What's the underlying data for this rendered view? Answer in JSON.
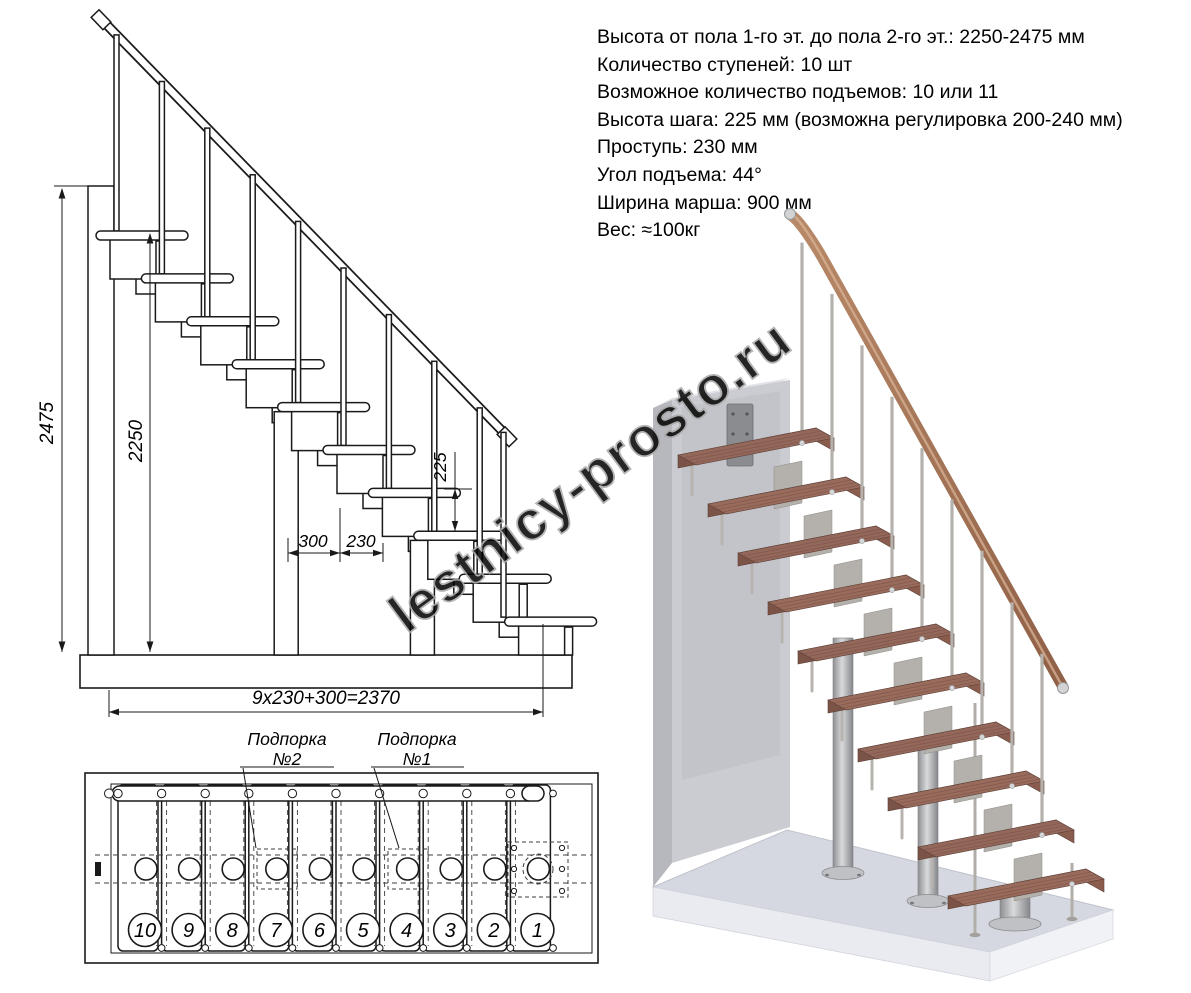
{
  "page": {
    "watermark_text": "lestnicy-prosto.ru"
  },
  "specs": {
    "lines": [
      "Высота от пола 1-го эт. до пола 2-го эт.: 2250-2475 мм",
      "Количество ступеней: 10 шт",
      "Возможное количество подъемов: 10 или 11",
      "Высота шага: 225 мм (возможна регулировка 200-240 мм)",
      "Проступь: 230 мм",
      "Угол подъема: 44°",
      "Ширина марша: 900 мм",
      "Вес: ≈100кг"
    ]
  },
  "side_view": {
    "dim_total_height": "2475",
    "dim_clear_height": "2250",
    "dim_step_rise": "225",
    "dim_top_run": "300",
    "dim_tread_run": "230",
    "dim_total_run": "9x230+300=2370"
  },
  "plan_view": {
    "support2_label_line1": "Подпорка",
    "support2_label_line2": "№2",
    "support1_label_line1": "Подпорка",
    "support1_label_line2": "№1",
    "step_numbers": [
      "10",
      "9",
      "8",
      "7",
      "6",
      "5",
      "4",
      "3",
      "2",
      "1"
    ]
  },
  "colors": {
    "drawing_line": "#1a1a1a",
    "watermark": "#a8a8a8",
    "wood_tread": "#96695b",
    "wood_rail": "#a87a5e",
    "metal": "#b5b2ad",
    "wall": "#cbccd2",
    "floor": "#d6d8e1"
  }
}
